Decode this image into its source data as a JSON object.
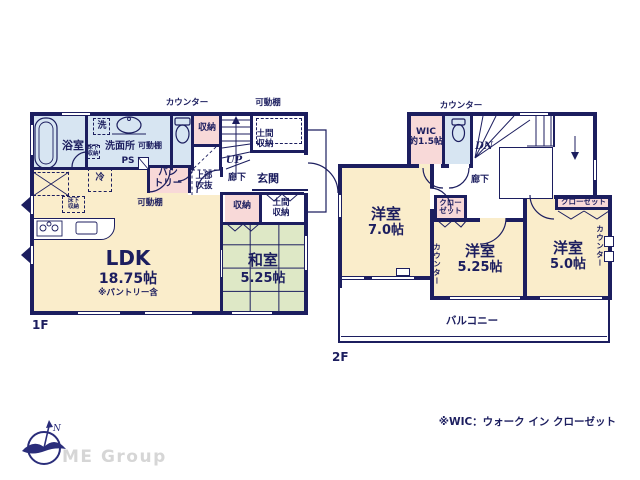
{
  "colors": {
    "wall": "#1c1e5f",
    "cream": "#faedcb",
    "pink": "#f8d9d8",
    "blue": "#d7e5f2",
    "green": "#dee8c6",
    "gray": "#d6d6d6"
  },
  "floor1": {
    "label": "1F",
    "counter_top": "カウンター",
    "movable_shelf_top": "可動棚",
    "bathroom": "浴室",
    "washer": "洗",
    "underfloor_storage_wash": "床下\n収納",
    "washroom": "洗面所",
    "movable_shelf_wash": "可動棚",
    "ps": "PS",
    "storage_top": "収納",
    "doma_storage_top": "土間\n収納",
    "up": "UP",
    "void_above": "上部\n吹抜",
    "hallway": "廊下",
    "entrance": "玄関",
    "fridge": "冷",
    "pantry": "パン\nトリー",
    "movable_shelf_pantry": "可動棚",
    "underfloor_storage_ldk": "床下\n収納",
    "storage_mid": "収納",
    "doma_storage_bottom": "土間\n収納",
    "ldk": "LDK",
    "ldk_size": "18.75帖",
    "ldk_note": "※パントリー含",
    "washitsu": "和室",
    "washitsu_size": "5.25帖"
  },
  "floor2": {
    "label": "2F",
    "counter_top": "カウンター",
    "wic": "WIC\n約1.5帖",
    "dn": "DN",
    "hallway": "廊下",
    "closet_mid": "クロー\nゼット",
    "closet_right": "クローゼット",
    "room1": "洋室",
    "room1_size": "7.0帖",
    "room2": "洋室",
    "room2_size": "5.25帖",
    "room3": "洋室",
    "room3_size": "5.0帖",
    "counter_v1": "カウンター",
    "counter_v2": "カウンター",
    "balcony": "バルコニー"
  },
  "footer": {
    "wic_note": "※WIC：ウォーク イン クローゼット",
    "brand": "ME Group",
    "compass_n": "N"
  }
}
